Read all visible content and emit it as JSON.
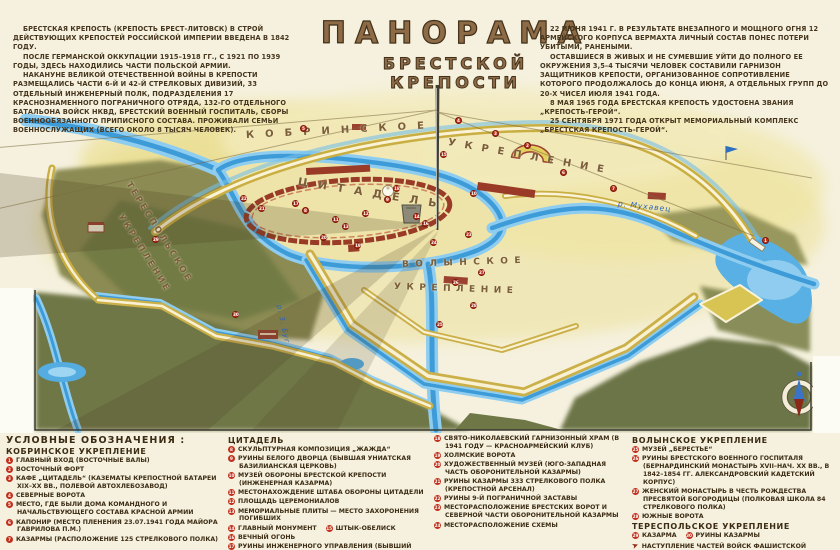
{
  "title": {
    "line1": "ПАНОРАМА",
    "line2": "БРЕСТСКОЙ КРЕПОСТИ"
  },
  "intro": {
    "left": [
      "БРЕСТСКАЯ КРЕПОСТЬ (КРЕПОСТЬ БРЕСТ-ЛИТОВСК) В СТРОЙ ДЕЙСТВУЮЩИХ КРЕПОСТЕЙ РОССИЙСКОЙ ИМПЕРИИ ВВЕДЕНА В 1842 ГОДУ.",
      "ПОСЛЕ ГЕРМАНСКОЙ ОККУПАЦИИ 1915–1918 ГГ., С 1921 ПО 1939 ГОДЫ, ЗДЕСЬ НАХОДИЛИСЬ ЧАСТИ ПОЛЬСКОЙ АРМИИ.",
      "НАКАНУНЕ ВЕЛИКОЙ ОТЕЧЕСТВЕННОЙ ВОЙНЫ В КРЕПОСТИ РАЗМЕЩАЛИСЬ ЧАСТИ 6-Й И 42-Й СТРЕЛКОВЫХ ДИВИЗИЙ, 33 ОТДЕЛЬНЫЙ ИНЖЕНЕРНЫЙ ПОЛК, ПОДРАЗДЕЛЕНИЯ 17 КРАСНОЗНАМЕННОГО ПОГРАНИЧНОГО ОТРЯДА, 132-ГО ОТДЕЛЬНОГО БАТАЛЬОНА ВОЙСК НКВД, БРЕСТСКИЙ ВОЕННЫЙ ГОСПИТАЛЬ, СБОРЫ ВОЕННООБЯЗАННОГО ПРИПИСНОГО СОСТАВА. ПРОЖИВАЛИ СЕМЬИ ВОЕННОСЛУЖАЩИХ (ВСЕГО ОКОЛО 8 ТЫСЯЧ ЧЕЛОВЕК)."
    ],
    "right": [
      "22 ИЮНЯ 1941 Г. В РЕЗУЛЬТАТЕ ВНЕЗАПНОГО И МОЩНОГО ОГНЯ 12 АРМЕЙСКОГО КОРПУСА ВЕРМАХТА ЛИЧНЫЙ СОСТАВ ПОНЕС ПОТЕРИ УБИТЫМИ, РАНЕНЫМИ.",
      "ОСТАВШИЕСЯ В ЖИВЫХ И НЕ СУМЕВШИЕ УЙТИ ДО ПОЛНОГО ЕЕ ОКРУЖЕНИЯ 3,5–4 ТЫСЯЧИ ЧЕЛОВЕК СОСТАВИЛИ ГАРНИЗОН ЗАЩИТНИКОВ КРЕПОСТИ, ОРГАНИЗОВАННОЕ СОПРОТИВЛЕНИЕ КОТОРОГО ПРОДОЛЖАЛОСЬ ДО КОНЦА ИЮНЯ, А ОТДЕЛЬНЫХ ГРУПП ДО 20-Х ЧИСЕЛ ИЮЛЯ 1941 ГОДА.",
      "8 МАЯ 1965 ГОДА БРЕСТСКАЯ КРЕПОСТЬ УДОСТОЕНА ЗВАНИЯ „КРЕПОСТЬ-ГЕРОЙ“.",
      "25 СЕНТЯБРЯ 1971 ГОДА ОТКРЫТ МЕМОРИАЛЬНЫЙ КОМПЛЕКС „БРЕСТСКАЯ КРЕПОСТЬ-ГЕРОЙ“."
    ]
  },
  "map": {
    "labels": [
      {
        "text": "КОБРИНСКОЕ",
        "x": 246,
        "y": 130,
        "rot": -3,
        "ls": 11,
        "size": 10
      },
      {
        "text": "УКРЕПЛЕНИЕ",
        "x": 448,
        "y": 137,
        "rot": 10,
        "ls": 9,
        "size": 10
      },
      {
        "text": "ЦИТАДЕЛЬ",
        "x": 298,
        "y": 175,
        "rot": 9,
        "ls": 10,
        "size": 11
      },
      {
        "text": "ВОЛЫНСКОЕ",
        "x": 402,
        "y": 260,
        "rot": -2,
        "ls": 6.5,
        "size": 9
      },
      {
        "text": "УКРЕПЛЕНИЕ",
        "x": 394,
        "y": 282,
        "rot": 2,
        "ls": 5.5,
        "size": 9
      },
      {
        "text": "ТЕРЕСПОЛЬСКОЕ",
        "x": 128,
        "y": 178,
        "rot": 58,
        "ls": 2.5,
        "size": 8.5
      },
      {
        "text": "УКРЕПЛЕНИЕ",
        "x": 120,
        "y": 210,
        "rot": 58,
        "ls": 2.5,
        "size": 8.5
      },
      {
        "text": "р. Мухавец",
        "x": 618,
        "y": 199,
        "rot": 6,
        "ls": 1,
        "size": 7.5,
        "color": "#2d62b8",
        "italic": true
      },
      {
        "text": "р. З. Буг",
        "x": 279,
        "y": 301,
        "rot": 78,
        "ls": 1,
        "size": 7,
        "color": "#2d62b8",
        "italic": true
      }
    ],
    "markers": [
      {
        "n": "1",
        "x": 762,
        "y": 237
      },
      {
        "n": "2",
        "x": 524,
        "y": 142
      },
      {
        "n": "3",
        "x": 492,
        "y": 130
      },
      {
        "n": "4",
        "x": 455,
        "y": 117
      },
      {
        "n": "5",
        "x": 300,
        "y": 125
      },
      {
        "n": "6",
        "x": 560,
        "y": 169
      },
      {
        "n": "7",
        "x": 610,
        "y": 185
      },
      {
        "n": "8",
        "x": 302,
        "y": 207
      },
      {
        "n": "9",
        "x": 384,
        "y": 196
      },
      {
        "n": "10",
        "x": 470,
        "y": 190
      },
      {
        "n": "11",
        "x": 332,
        "y": 216
      },
      {
        "n": "12",
        "x": 362,
        "y": 210
      },
      {
        "n": "13",
        "x": 342,
        "y": 223
      },
      {
        "n": "14",
        "x": 413,
        "y": 213
      },
      {
        "n": "15",
        "x": 440,
        "y": 151
      },
      {
        "n": "16",
        "x": 422,
        "y": 220
      },
      {
        "n": "17",
        "x": 292,
        "y": 200
      },
      {
        "n": "18",
        "x": 393,
        "y": 185
      },
      {
        "n": "19",
        "x": 354,
        "y": 242
      },
      {
        "n": "20",
        "x": 320,
        "y": 234
      },
      {
        "n": "21",
        "x": 258,
        "y": 205
      },
      {
        "n": "22",
        "x": 240,
        "y": 195
      },
      {
        "n": "23",
        "x": 465,
        "y": 231
      },
      {
        "n": "24",
        "x": 430,
        "y": 239
      },
      {
        "n": "25",
        "x": 436,
        "y": 321
      },
      {
        "n": "26",
        "x": 452,
        "y": 279
      },
      {
        "n": "27",
        "x": 478,
        "y": 269
      },
      {
        "n": "28",
        "x": 470,
        "y": 302
      },
      {
        "n": "29",
        "x": 152,
        "y": 236
      },
      {
        "n": "30",
        "x": 232,
        "y": 311
      }
    ],
    "colors": {
      "water": "#3d9bd8",
      "water_light": "#8fcdf0",
      "terrain_olive": "#6f7747",
      "rampart_yellow": "#cbb049",
      "wall_red": "#993b27",
      "marker_red": "#c0301c",
      "background_cream": "#f5f1de",
      "title_brown": "#8d6b46",
      "text_brown": "#3c2c14"
    }
  },
  "legend": {
    "columns": [
      {
        "title": "УСЛОВНЫЕ ОБОЗНАЧЕНИЯ :",
        "sections": [
          {
            "header": "КОБРИНСКОЕ УКРЕПЛЕНИЕ",
            "items": [
              [
                {
                  "n": "1",
                  "text": "ГЛАВНЫЙ ВХОД (ВОСТОЧНЫЕ ВАЛЫ)"
                }
              ],
              [
                {
                  "n": "2",
                  "text": "ВОСТОЧНЫЙ ФОРТ"
                }
              ],
              [
                {
                  "n": "3",
                  "text": "КАФЕ „ЦИТАДЕЛЬ“ (КАЗЕМАТЫ КРЕПОСТНОЙ БАТАРЕИ XIX–XX ВВ., ПОЛЕВОЙ АВТОХЛЕБОЗАВОД)"
                }
              ],
              [
                {
                  "n": "4",
                  "text": "СЕВЕРНЫЕ ВОРОТА"
                }
              ],
              [
                {
                  "n": "5",
                  "text": "МЕСТО, ГДЕ БЫЛИ ДОМА КОМАНДНОГО И НАЧАЛЬСТВУЮЩЕГО СОСТАВА КРАСНОЙ АРМИИ"
                }
              ],
              [
                {
                  "n": "6",
                  "text": "КАПОНИР (МЕСТО ПЛЕНЕНИЯ 23.07.1941 ГОДА МАЙОРА ГАВРИЛОВА П.М.)"
                }
              ],
              [
                {
                  "n": "7",
                  "text": "КАЗАРМЫ (РАСПОЛОЖЕНИЕ 125 СТРЕЛКОВОГО ПОЛКА)"
                }
              ]
            ]
          }
        ]
      },
      {
        "title": "",
        "sections": [
          {
            "header": "ЦИТАДЕЛЬ",
            "items": [
              [
                {
                  "n": "8",
                  "text": "СКУЛЬПТУРНАЯ КОМПОЗИЦИЯ „ЖАЖДА“"
                }
              ],
              [
                {
                  "n": "9",
                  "text": "РУИНЫ БЕЛОГО ДВОРЦА (БЫВШАЯ УНИАТСКАЯ БАЗИЛИАНСКАЯ ЦЕРКОВЬ)"
                }
              ],
              [
                {
                  "n": "10",
                  "text": "МУЗЕЙ ОБОРОНЫ БРЕСТСКОЙ КРЕПОСТИ (ИНЖЕНЕРНАЯ КАЗАРМА)"
                }
              ],
              [
                {
                  "n": "11",
                  "text": "МЕСТОНАХОЖДЕНИЕ ШТАБА ОБОРОНЫ ЦИТАДЕЛИ"
                }
              ],
              [
                {
                  "n": "12",
                  "text": "ПЛОЩАДЬ ЦЕРЕМОНИАЛОВ"
                }
              ],
              [
                {
                  "n": "13",
                  "text": "МЕМОРИАЛЬНЫЕ ПЛИТЫ — МЕСТО ЗАХОРОНЕНИЯ ПОГИБШИХ"
                }
              ],
              [
                {
                  "n": "14",
                  "text": "ГЛАВНЫЙ МОНУМЕНТ"
                },
                {
                  "n": "15",
                  "text": "ШТЫК-ОБЕЛИСК"
                }
              ],
              [
                {
                  "n": "16",
                  "text": "ВЕЧНЫЙ ОГОНЬ"
                }
              ],
              [
                {
                  "n": "17",
                  "text": "РУИНЫ ИНЖЕНЕРНОГО УПРАВЛЕНИЯ (БЫВШИЙ КОЛЛЕГИУМ ИЕЗУИТОВ)"
                }
              ]
            ]
          }
        ]
      },
      {
        "title": "",
        "sections": [
          {
            "header": "",
            "items": [
              [
                {
                  "n": "18",
                  "text": "СВЯТО-НИКОЛАЕВСКИЙ ГАРНИЗОННЫЙ ХРАМ (В 1941 ГОДУ — КРАСНОАРМЕЙСКИЙ КЛУБ)"
                }
              ],
              [
                {
                  "n": "19",
                  "text": "ХОЛМСКИЕ ВОРОТА"
                }
              ],
              [
                {
                  "n": "20",
                  "text": "ХУДОЖЕСТВЕННЫЙ МУЗЕЙ (ЮГО-ЗАПАДНАЯ ЧАСТЬ ОБОРОНИТЕЛЬНОЙ КАЗАРМЫ)"
                }
              ],
              [
                {
                  "n": "21",
                  "text": "РУИНЫ КАЗАРМЫ 333 СТРЕЛКОВОГО ПОЛКА (КРЕПОСТНОЙ АРСЕНАЛ)"
                }
              ],
              [
                {
                  "n": "22",
                  "text": "РУИНЫ 9-Й ПОГРАНИЧНОЙ ЗАСТАВЫ"
                }
              ],
              [
                {
                  "n": "23",
                  "text": "МЕСТОРАСПОЛОЖЕНИЕ БРЕСТСКИХ ВОРОТ И СЕВЕРНОЙ ЧАСТИ ОБОРОНИТЕЛЬНОЙ КАЗАРМЫ"
                }
              ],
              [
                {
                  "n": "24",
                  "text": "МЕСТОРАСПОЛОЖЕНИЕ СХЕМЫ"
                }
              ]
            ]
          }
        ]
      },
      {
        "title": "",
        "sections": [
          {
            "header": "ВОЛЫНСКОЕ УКРЕПЛЕНИЕ",
            "items": [
              [
                {
                  "n": "25",
                  "text": "МУЗЕЙ „БЕРЕСТЬЕ“"
                }
              ],
              [
                {
                  "n": "26",
                  "text": "РУИНЫ БРЕСТСКОГО ВОЕННОГО ГОСПИТАЛЯ (БЕРНАРДИНСКИЙ МОНАСТЫРЬ XVII–НАЧ. XX ВВ., В 1842–1854 ГГ. АЛЕКСАНДРОВСКИЙ КАДЕТСКИЙ КОРПУС)"
                }
              ],
              [
                {
                  "n": "27",
                  "text": "ЖЕНСКИЙ МОНАСТЫРЬ В ЧЕСТЬ РОЖДЕСТВА ПРЕСВЯТОЙ БОГОРОДИЦЫ (ПОЛКОВАЯ ШКОЛА 84 СТРЕЛКОВОГО ПОЛКА)"
                }
              ],
              [
                {
                  "n": "28",
                  "text": "ЮЖНЫЕ ВОРОТА"
                }
              ]
            ]
          },
          {
            "header": "ТЕРЕСПОЛЬСКОЕ УКРЕПЛЕНИЕ",
            "items": [
              [
                {
                  "n": "29",
                  "text": "КАЗАРМА"
                },
                {
                  "n": "30",
                  "text": "РУИНЫ КАЗАРМЫ"
                }
              ],
              [
                {
                  "arrow": true,
                  "text": "НАСТУПЛЕНИЕ ЧАСТЕЙ ВОЙСК ФАШИСТСКОЙ ГЕРМАНИИ"
                }
              ]
            ]
          }
        ]
      }
    ]
  }
}
